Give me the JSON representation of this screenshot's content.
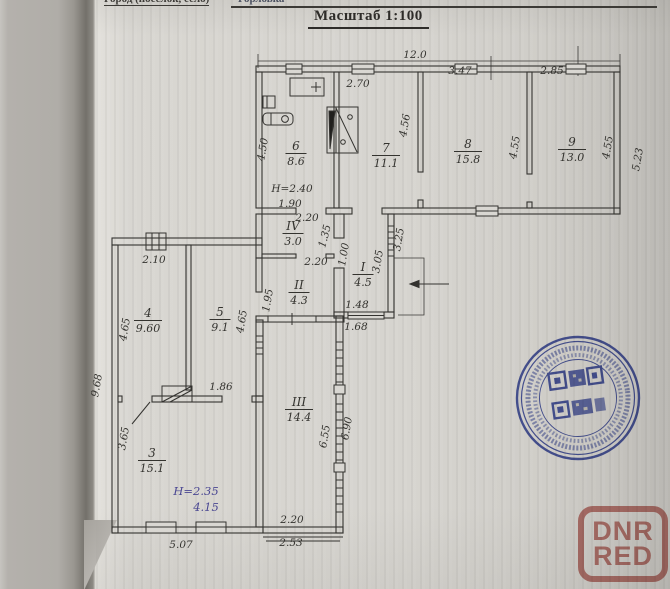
{
  "header": {
    "form_label": "Город (поселок, село)",
    "form_value": "Горловка",
    "title": "Масштаб 1:100"
  },
  "plan": {
    "rooms": [
      {
        "number": "6",
        "area": "8.6",
        "x": 296,
        "y": 150
      },
      {
        "number": "7",
        "area": "11.1",
        "x": 386,
        "y": 152
      },
      {
        "number": "8",
        "area": "15.8",
        "x": 468,
        "y": 148
      },
      {
        "number": "9",
        "area": "13.0",
        "x": 572,
        "y": 146
      },
      {
        "number": "IV",
        "area": "3.0",
        "x": 293,
        "y": 230
      },
      {
        "number": "II",
        "area": "4.3",
        "x": 299,
        "y": 289
      },
      {
        "number": "I",
        "area": "4.5",
        "x": 363,
        "y": 271
      },
      {
        "number": "4",
        "area": "9.60",
        "x": 148,
        "y": 317
      },
      {
        "number": "5",
        "area": "9.1",
        "x": 220,
        "y": 316
      },
      {
        "number": "3",
        "area": "15.1",
        "x": 152,
        "y": 457
      },
      {
        "number": "III",
        "area": "14.4",
        "x": 299,
        "y": 406
      }
    ],
    "dimensions": [
      {
        "t": "12.0",
        "x": 415,
        "y": 58
      },
      {
        "t": "2.70",
        "x": 358,
        "y": 87
      },
      {
        "t": "3.47",
        "x": 460,
        "y": 74
      },
      {
        "t": "2.85",
        "x": 552,
        "y": 74
      },
      {
        "t": "4.50",
        "x": 266,
        "y": 150,
        "r": -80
      },
      {
        "t": "4.56",
        "x": 408,
        "y": 126,
        "r": -80
      },
      {
        "t": "4.55",
        "x": 518,
        "y": 148,
        "r": -80
      },
      {
        "t": "4.55",
        "x": 611,
        "y": 148,
        "r": -80
      },
      {
        "t": "5.23",
        "x": 641,
        "y": 160,
        "r": -80
      },
      {
        "t": "H=2.40",
        "x": 292,
        "y": 192
      },
      {
        "t": "1.90",
        "x": 290,
        "y": 207
      },
      {
        "t": "2.20",
        "x": 307,
        "y": 221
      },
      {
        "t": "1.35",
        "x": 328,
        "y": 237,
        "r": -75
      },
      {
        "t": "2.20",
        "x": 316,
        "y": 265
      },
      {
        "t": "1.00",
        "x": 347,
        "y": 255,
        "r": -80
      },
      {
        "t": "3.05",
        "x": 381,
        "y": 262,
        "r": -80
      },
      {
        "t": "3.25",
        "x": 402,
        "y": 240,
        "r": -80
      },
      {
        "t": "1.95",
        "x": 271,
        "y": 301,
        "r": -80
      },
      {
        "t": "1.48",
        "x": 357,
        "y": 308
      },
      {
        "t": "1.68",
        "x": 356,
        "y": 330
      },
      {
        "t": "2.10",
        "x": 154,
        "y": 263
      },
      {
        "t": "4.65",
        "x": 128,
        "y": 330,
        "r": -80
      },
      {
        "t": "4.65",
        "x": 245,
        "y": 322,
        "r": -80
      },
      {
        "t": "9.68",
        "x": 100,
        "y": 386,
        "r": -80
      },
      {
        "t": "1.86",
        "x": 221,
        "y": 390
      },
      {
        "t": "3.65",
        "x": 127,
        "y": 439,
        "r": -80
      },
      {
        "t": "6.55",
        "x": 328,
        "y": 437,
        "r": -80
      },
      {
        "t": "6.90",
        "x": 350,
        "y": 429,
        "r": -80
      },
      {
        "t": "H=2.35",
        "x": 196,
        "y": 495,
        "c": "ink"
      },
      {
        "t": "4.15",
        "x": 206,
        "y": 511,
        "c": "ink"
      },
      {
        "t": "5.07",
        "x": 181,
        "y": 548
      },
      {
        "t": "2.20",
        "x": 292,
        "y": 523
      },
      {
        "t": "2.53",
        "x": 291,
        "y": 546
      }
    ]
  },
  "stamp": {
    "color": "#2c3da0"
  },
  "watermark": {
    "line1": "DNR",
    "line2": "RED",
    "color": "#b9564e"
  }
}
